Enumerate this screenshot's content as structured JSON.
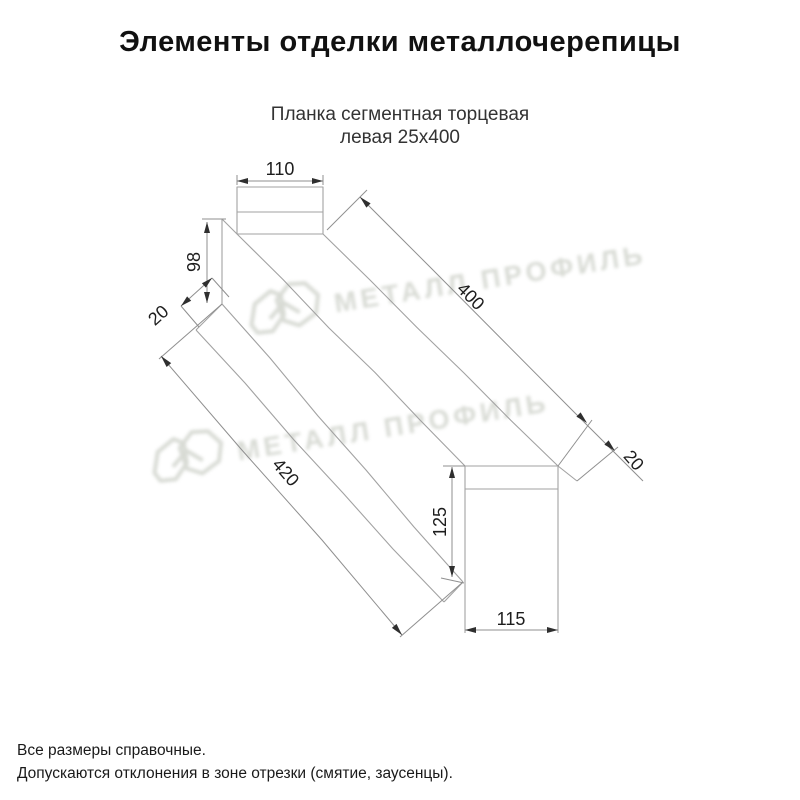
{
  "header": {
    "title": "Элементы отделки металлочерепицы"
  },
  "product": {
    "name_line1": "Планка сегментная торцевая",
    "name_line2": "левая 25х400"
  },
  "drawing": {
    "dims": {
      "top_width": "110",
      "side_height": "98",
      "near_flange": "20",
      "length_top": "400",
      "end_flange": "20",
      "length_bottom": "420",
      "far_height": "125",
      "far_width": "115"
    }
  },
  "watermark": {
    "brand": "МЕТАЛЛ ПРОФИЛЬ"
  },
  "footer": {
    "note1": "Все размеры справочные.",
    "note2": "Допускаются отклонения в зоне отрезки (смятие, заусенцы)."
  },
  "colors": {
    "drawing_line": "#a2a2a2",
    "dimension_line": "#8f8f8f",
    "arrow": "#2f2f2f",
    "text": "#1d1d1d",
    "watermark": "#d4d7d0"
  }
}
